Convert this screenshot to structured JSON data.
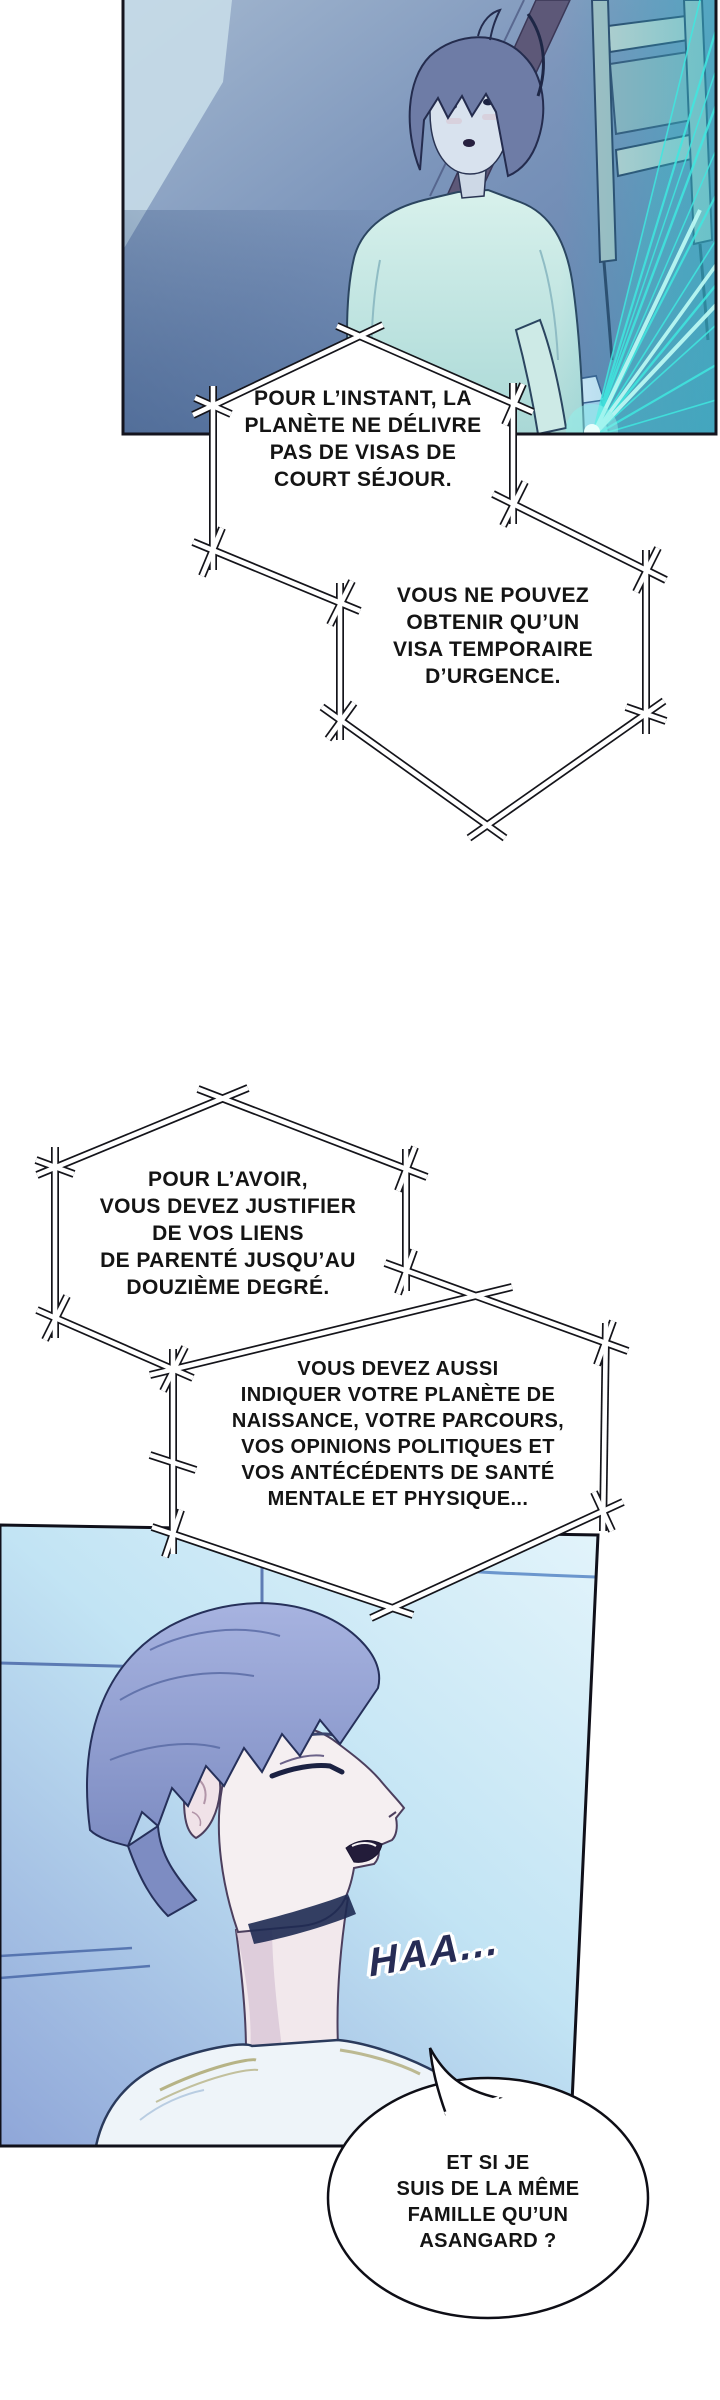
{
  "page": {
    "type": "webtoon-page",
    "background": "#ffffff"
  },
  "panels": [
    {
      "id": "panel-1"
    },
    {
      "id": "panel-2"
    }
  ],
  "bubbles": [
    {
      "id": "narration-1",
      "lines": [
        "POUR L’INSTANT, LA",
        "PLANÈTE NE DÉLIVRE",
        "PAS DE VISAS DE",
        "COURT SÉJOUR."
      ]
    },
    {
      "id": "narration-2",
      "lines": [
        "VOUS NE POUVEZ",
        "OBTENIR QU’UN",
        "VISA TEMPORAIRE",
        "D’URGENCE."
      ]
    },
    {
      "id": "narration-3",
      "lines": [
        "POUR L’AVOIR,",
        "VOUS DEVEZ JUSTIFIER",
        "DE VOS LIENS",
        "DE PARENTÉ JUSQU’AU",
        "DOUZIÈME DEGRÉ."
      ]
    },
    {
      "id": "narration-4",
      "lines": [
        "VOUS DEVEZ AUSSI",
        "INDIQUER VOTRE PLANÈTE DE",
        "NAISSANCE, VOTRE PARCOURS,",
        "VOS OPINIONS POLITIQUES ET",
        "VOS ANTÉCÉDENTS DE SANTÉ",
        "MENTALE ET PHYSIQUE..."
      ]
    },
    {
      "id": "speech-1",
      "lines": [
        "ET SI JE",
        "SUIS DE LA MÊME",
        "FAMILLE QU’UN",
        "ASANGARD ?"
      ]
    }
  ],
  "sfx": {
    "text": "HAA..."
  },
  "palette": {
    "ink": "#141414",
    "hologram_cyan": "#3fe8e0",
    "panel1_wall_blue": "#7490b8",
    "panel2_sky_blue": "#c2e4f4",
    "sfx_navy": "#272c55",
    "hair_blue": "#8c9cd0",
    "shirt_mint": "#cdeeea"
  }
}
